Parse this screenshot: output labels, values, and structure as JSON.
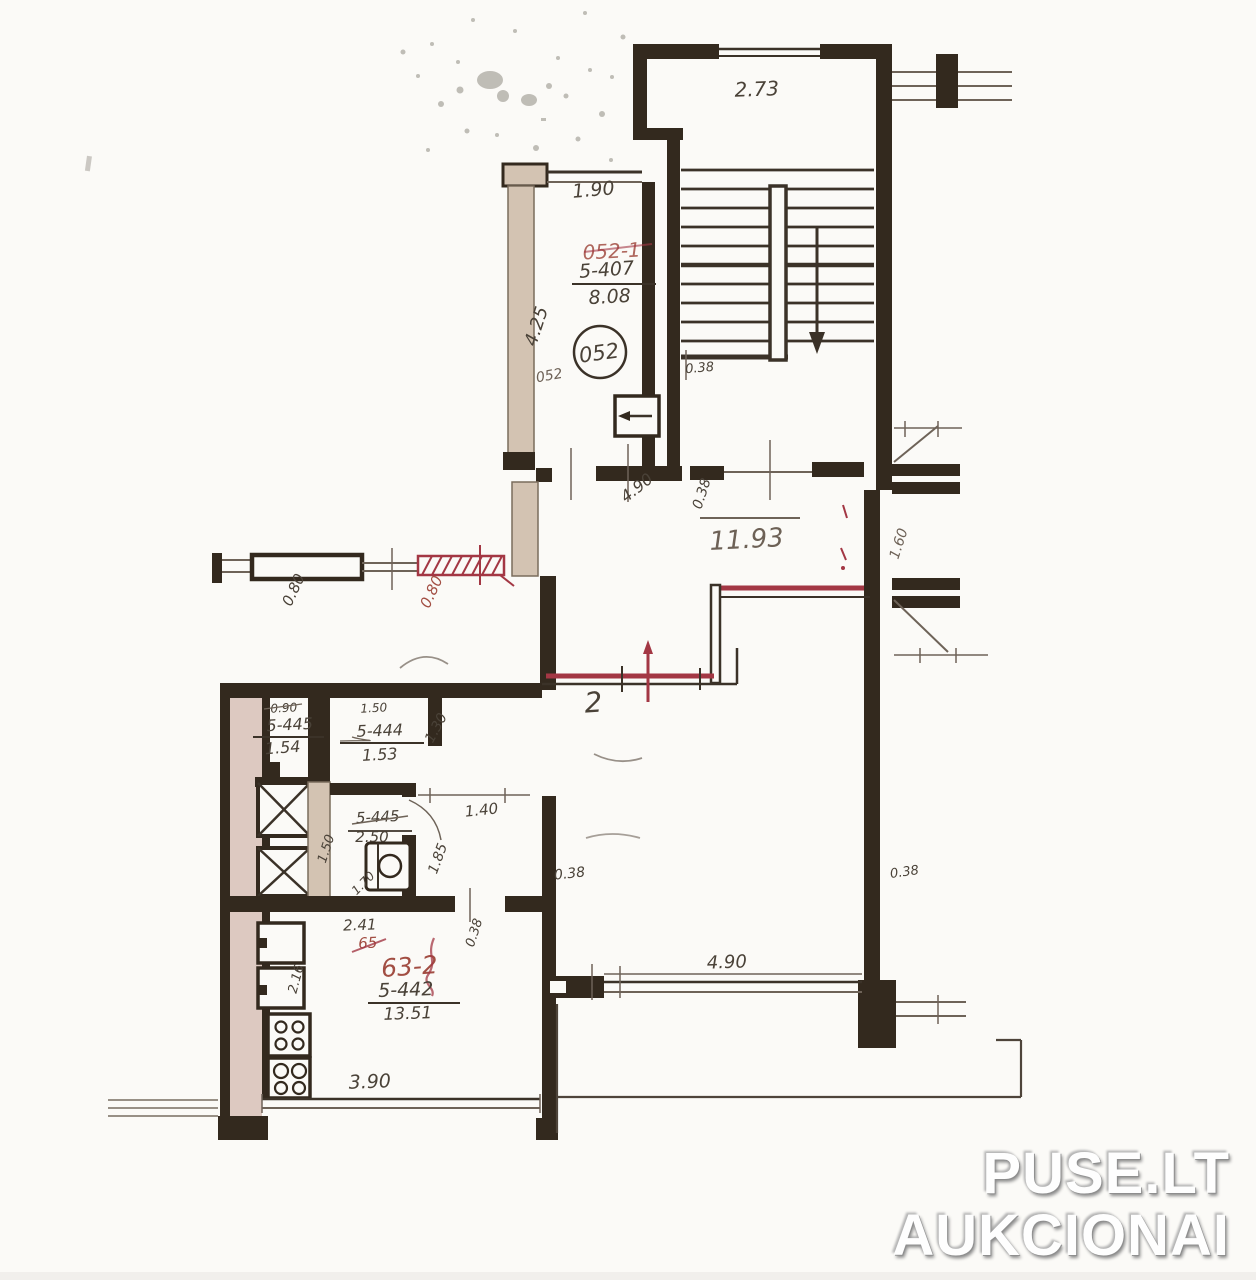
{
  "watermark": {
    "line1": "PUSE.LT",
    "line2": "AUKCIONAI"
  },
  "colors": {
    "wall": "#33291e",
    "pencil": "#6e6358",
    "red_mark": "#a33744",
    "red_text": "#a24e43",
    "tan": "#d3c3b2",
    "tan_pink": "#ddc9c1",
    "paper": "#fbfaf7"
  },
  "labels": {
    "stairwell_width": "2.73",
    "stairwell_tread_dim": "0.38",
    "vestibule_width": "1.90",
    "vestibule_room_red": "052-1",
    "vestibule_apt": "5-407",
    "vestibule_area": "8.08",
    "vestibule_depth": "4.25",
    "vestibule_circle": "052",
    "vestibule_small": "052",
    "hall_opening_a": "4.90",
    "hall_opening_b": "0.38",
    "hall_area": "11.93",
    "right_niche": "1.60",
    "window_left": "0.80",
    "window_right_red": "0.80",
    "room_number": "2",
    "wc_width": "0.90",
    "wc_apt": "5-445",
    "wc_area": "1.54",
    "storage_width": "1.50",
    "storage_apt": "5-444",
    "storage_area": "1.53",
    "storage_depth": "1.30",
    "corridor_width": "1.40",
    "bath_col_dim": "1.50",
    "bath_apt": "5-445",
    "bath_area": "2.50",
    "corridor_depth": "1.85",
    "bath_width": "1.70",
    "block_width": "2.41",
    "door_wall_dim": "0.38",
    "kitchen_old_red": "65",
    "kitchen_room_red": "63-2",
    "kitchen_apt": "5-442",
    "kitchen_area": "13.51",
    "kitchen_left_dim": "2.16",
    "room2_window": "4.90",
    "room2_wall_a": "0.38",
    "room2_wall_b": "0.38",
    "kitchen_window": "3.90"
  }
}
